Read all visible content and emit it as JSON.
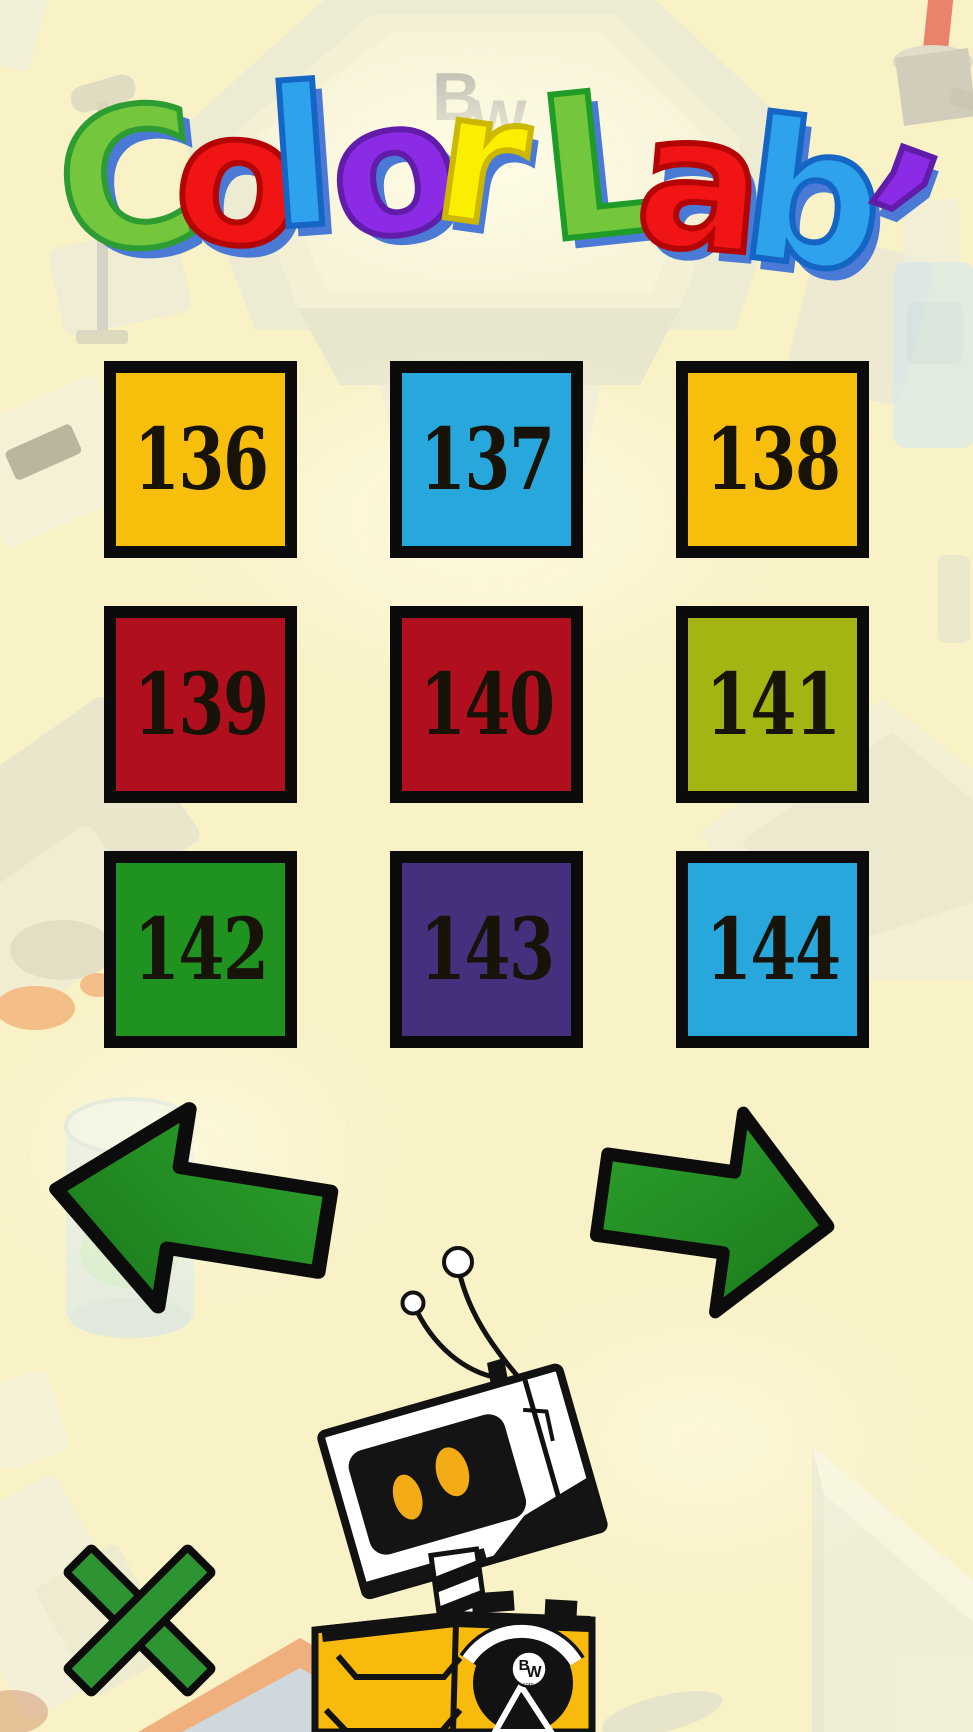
{
  "title": {
    "text": "Color Lab’",
    "shadow": "#4A79D6",
    "letters": [
      {
        "ch": "C",
        "color": "#74C63C",
        "stroke": "#2D9C33"
      },
      {
        "ch": "o",
        "color": "#F01414",
        "stroke": "#B40505"
      },
      {
        "ch": "l",
        "color": "#2EA2EC",
        "stroke": "#1566C4"
      },
      {
        "ch": "o",
        "color": "#8B2BE5",
        "stroke": "#611CA9"
      },
      {
        "ch": "r",
        "color": "#FBEF00",
        "stroke": "#CCB800"
      },
      {
        "ch": "L",
        "color": "#74C63C",
        "stroke": "#1F9C28"
      },
      {
        "ch": "a",
        "color": "#F01414",
        "stroke": "#B40505"
      },
      {
        "ch": "b",
        "color": "#2EA2EC",
        "stroke": "#1566C4"
      },
      {
        "ch": "’",
        "color": "#8B2BE5",
        "stroke": "#611CA9"
      }
    ]
  },
  "grid": {
    "tiles": [
      {
        "label": "136",
        "color": "#F7BE0B"
      },
      {
        "label": "137",
        "color": "#27A7DB"
      },
      {
        "label": "138",
        "color": "#F7BE0B"
      },
      {
        "label": "139",
        "color": "#B00F1D"
      },
      {
        "label": "140",
        "color": "#B00F1D"
      },
      {
        "label": "141",
        "color": "#A3B513"
      },
      {
        "label": "142",
        "color": "#20921F"
      },
      {
        "label": "143",
        "color": "#44307C"
      },
      {
        "label": "144",
        "color": "#27A7DB"
      }
    ]
  },
  "nav": {
    "left": {
      "direction": "previous",
      "color": "#218A21"
    },
    "right": {
      "direction": "next",
      "color": "#218A21"
    }
  },
  "close": {
    "color": "#2E9432"
  },
  "robot": {
    "logo": {
      "b": "B",
      "w": "W",
      "corp": "corp."
    }
  },
  "background": {
    "machine": {
      "b": "B",
      "w": "W",
      "p": "p."
    }
  }
}
